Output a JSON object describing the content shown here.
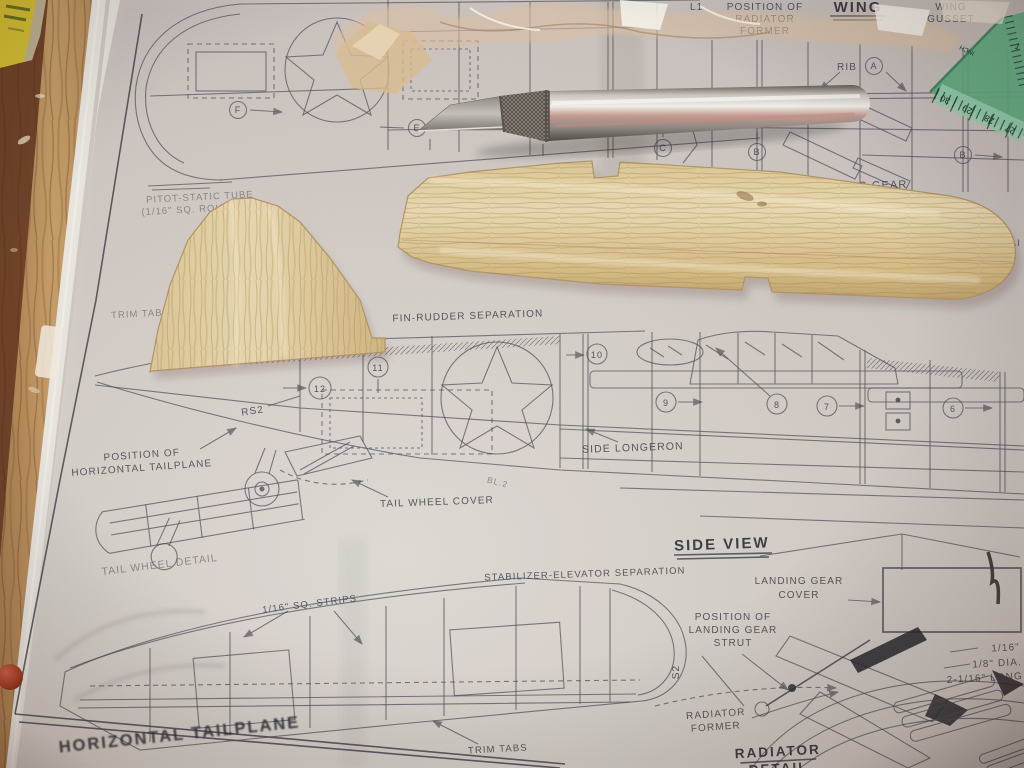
{
  "photo": {
    "description": "Photograph of a balsa model airplane plan sheet on a wooden workbench with two cut balsa blanks, a metal hobby knife, a green ruler corner, crumpled tape and a yellow box edge"
  },
  "plan": {
    "titles": {
      "wing": "WING",
      "side_view": "SIDE VIEW",
      "horizontal_tailplane": "HORIZONTAL TAILPLANE",
      "radiator_detail_1": "RADIATOR",
      "radiator_detail_2": "DETAIL"
    },
    "labels": {
      "l1": "L1",
      "pos_radiator_former_1": "POSITION OF",
      "pos_radiator_former_2": "RADIATOR",
      "pos_radiator_former_3": "FORMER",
      "wing_gusset_1": "WING",
      "wing_gusset_2": "GUSSET",
      "rib": "RIB",
      "l2": "L2",
      "landing_gear_partial": "ING GEAR",
      "ai_partial": "AI",
      "pitot_1": "PITOT-STATIC TUBE",
      "pitot_2": "(1/16\" SQ. ROUNDED)",
      "trim_tab": "TRIM TAB",
      "fin_rudder_sep": "FIN-RUDDER SEPARATION",
      "rs2": "RS2",
      "bl2": "BL.2",
      "side_longeron": "SIDE LONGERON",
      "tail_wheel_cover": "TAIL WHEEL COVER",
      "pos_horiz_tail_1": "POSITION OF",
      "pos_horiz_tail_2": "HORIZONTAL TAILPLANE",
      "tail_wheel_detail": "TAIL WHEEL DETAIL",
      "stab_elev_sep": "STABILIZER-ELEVATOR SEPARATION",
      "lg_cover_1": "LANDING GEAR",
      "lg_cover_2": "COVER",
      "pos_lg_strut_1": "POSITION OF",
      "pos_lg_strut_2": "LANDING GEAR",
      "pos_lg_strut_3": "STRUT",
      "sq_strips": "1/16\" SQ. STRIPS",
      "s2": "S2",
      "trim_tabs": "TRIM TABS",
      "radiator_former_1": "RADIATOR",
      "radiator_former_2": "FORMER",
      "dim_116": "1/16\"",
      "dim_18_dia": "1/8\" DIA.",
      "dim_2116_long": "2-1/16\" LONG"
    },
    "frame_letters": {
      "a": "A",
      "b": "B",
      "c": "C",
      "d": "D",
      "e": "E",
      "f": "F",
      "b2": "B"
    },
    "frame_numbers": {
      "n6": "6",
      "n7": "7",
      "n8": "8",
      "n9": "9",
      "n10": "10",
      "n11": "11",
      "n12": "12"
    }
  },
  "ruler": {
    "n30": "30",
    "n29": "29",
    "n28": "28",
    "n27": "27",
    "unit": "INCH",
    "side": "1"
  },
  "colors": {
    "table_wood": "#7c4a2e",
    "table_wood_light": "#c49a66",
    "paper": "#d7d3d0",
    "plan_ink": "#4c4c56",
    "balsa": "#e6d4a8",
    "knife_steel": "#d5d1cc",
    "ruler_green": "#5cb286",
    "red_dot": "#a83a22",
    "yellow_object": "#d9c531"
  }
}
